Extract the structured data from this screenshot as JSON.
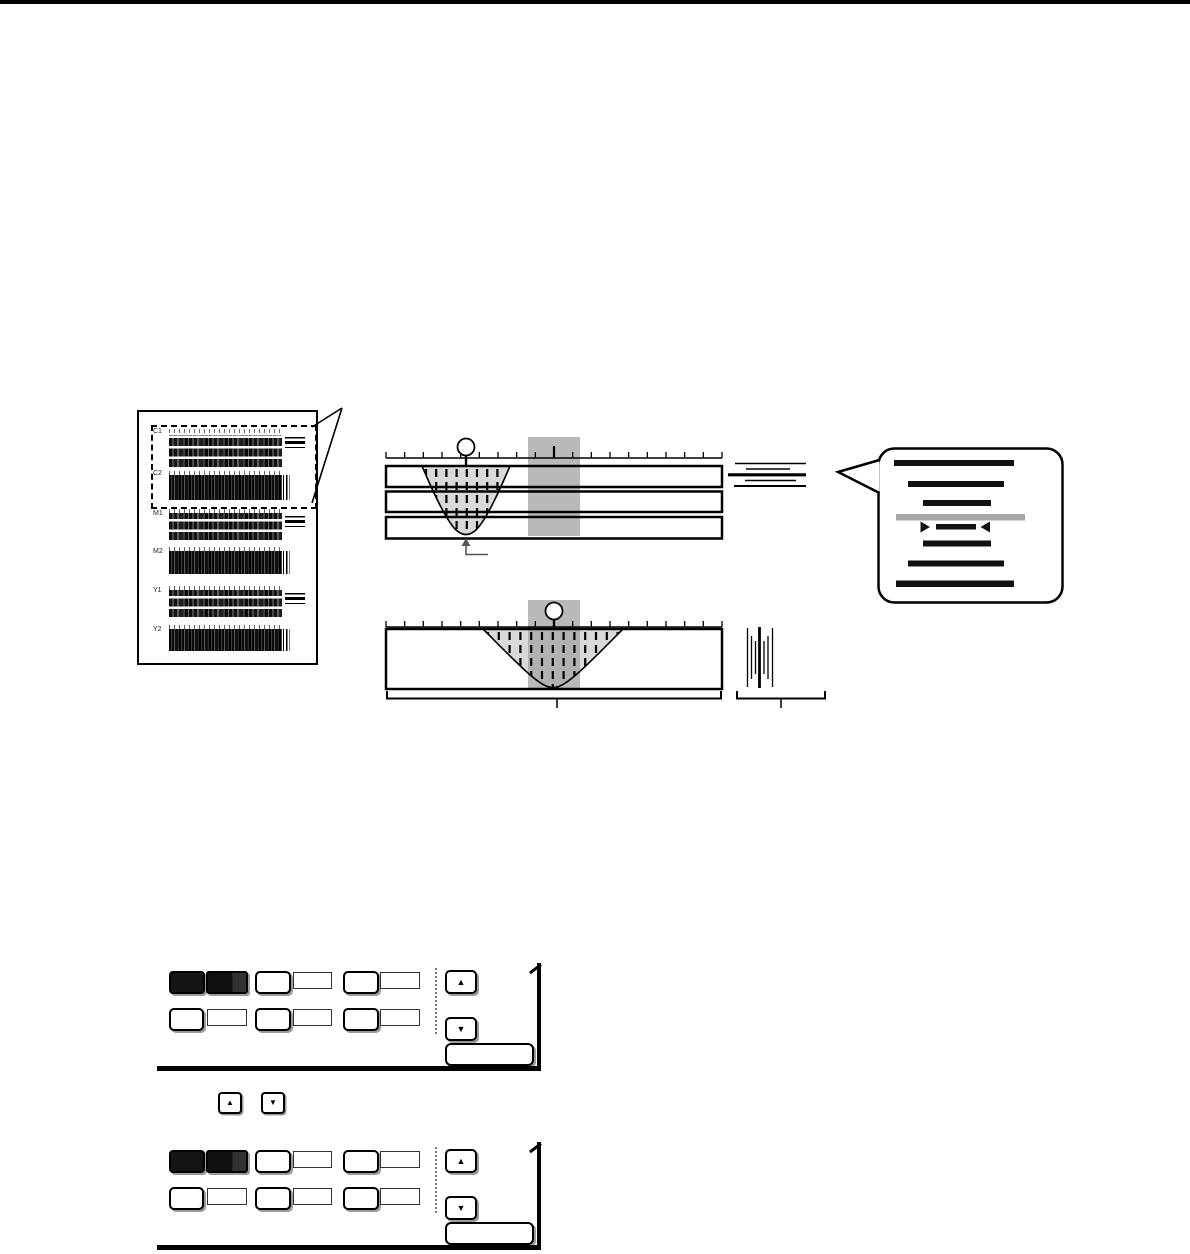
{
  "page": {
    "background": "#ffffff",
    "top_bar_color": "#000000"
  },
  "test_chart": {
    "band_labels": [
      "C1",
      "C2",
      "M1",
      "M2",
      "Y1",
      "Y2"
    ]
  },
  "icons": {
    "up_arrow": "▲",
    "down_arrow": "▼"
  },
  "colors": {
    "shade_band": "#a8a8a8",
    "notch_fill": "#d9d9d9",
    "callout_gray": "#a6a6a6",
    "panel_button_dark": "#141414",
    "panel_button_dark_light": "#323232"
  }
}
